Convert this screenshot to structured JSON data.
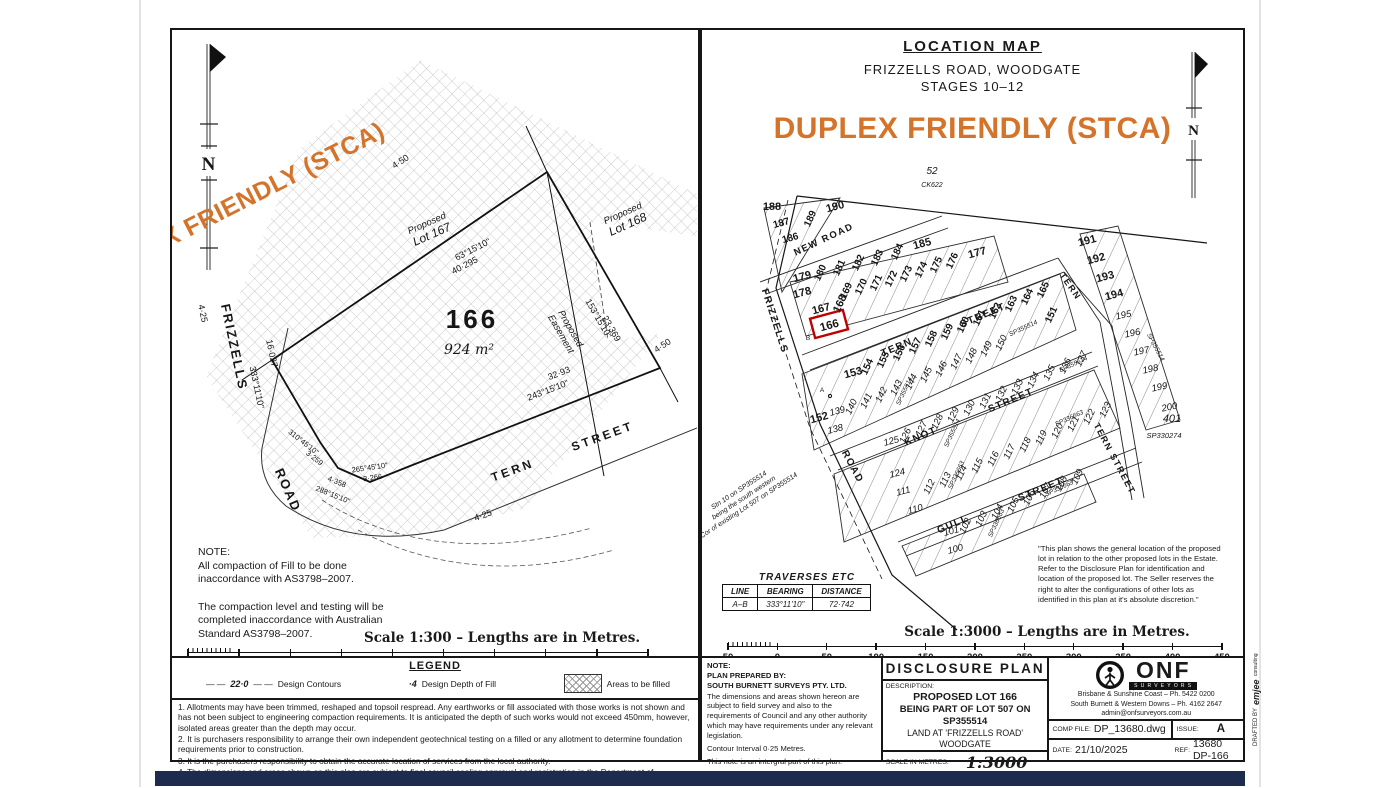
{
  "colors": {
    "accent": "#d4732a",
    "highlight_red": "#c00000",
    "footer_bar": "#1d2b4e",
    "ink": "#1a1a1a"
  },
  "site_plan": {
    "banner": "DUPLEX FRIENDLY (STCA)",
    "north_label": "N",
    "lot_number": "166",
    "lot_area": "924 m²",
    "adjacent": {
      "p167a": "Proposed",
      "p167b": "Lot 167",
      "p168a": "Proposed",
      "p168b": "Lot 168",
      "easea": "Proposed",
      "easeb": "Easement"
    },
    "streets": {
      "frizzells": "FRIZZELLS",
      "road": "ROAD",
      "tern": "TERN",
      "street": "STREET"
    },
    "dims": {
      "d450a": "4·50",
      "d450b": "4·50",
      "d425a": "4·25",
      "d425b": "4·25",
      "b_top": "63°15'10\"",
      "l_top": "40·295",
      "b_east": "153°15'10\"",
      "l_east": "23·369",
      "b_south": "243°15'10\"",
      "l_south": "32·93",
      "b_west": "333°11'10\"",
      "l_west": "16·027",
      "b_c1": "310°45'10\"",
      "l_c1": "3·259",
      "b_c2": "265°45'10\"",
      "l_c2": "3·266",
      "b_c3": "288°15'10\"",
      "l_c3": "4·358"
    },
    "note": "NOTE:\nAll compaction of Fill to be done\ninaccordance with AS3798–2007.\n\nThe compaction level and testing will be\ncompleted inaccordance with Australian\nStandard AS3798–2007.",
    "scale_caption": "Scale 1:300 – Lengths are in Metres.",
    "scale_ticks": [
      "5",
      "0",
      "5",
      "10",
      "15",
      "20",
      "25",
      "30",
      "35",
      "40"
    ]
  },
  "legend": {
    "title": "LEGEND",
    "contour_value": "22·0",
    "contour_label": "Design Contours",
    "depth_symbol": "·4",
    "depth_label": "Design Depth of Fill",
    "fill_label": "Areas to be filled"
  },
  "notes": {
    "n1": "1. Allotments may have been trimmed, reshaped and topsoil respread. Any earthworks or fill associated with those works is not shown and has not been subject to engineering compaction requirements. It is anticipated the depth of such works would not exceed 450mm, however, isolated areas greater than the depth may occur.",
    "n2": "2. It is purchasers responsibility to arrange their own independent geotechnical testing on a filled or any allotment to determine foundation requirements prior to construction.",
    "n3": "3. It is the purchasers responsibility to obtain the accurate location of services from the local authority.",
    "n4": "4. The dimensions and areas shown on this plan are subject to final council sealing approval and registration in the Department of Resources."
  },
  "location_map": {
    "title": "LOCATION MAP",
    "address": "FRIZZELLS ROAD, WOODGATE",
    "stages": "STAGES 10–12",
    "banner": "DUPLEX FRIENDLY (STCA)",
    "north_label": "N",
    "parcel_above": {
      "lot": "52",
      "plan": "CK622"
    },
    "streets": {
      "new_road": "NEW ROAD",
      "tern_1": "TERN",
      "tern_2": "STREET",
      "knot_1": "KNOT",
      "knot_2": "STREET",
      "gull_1": "GULL",
      "gull_2": "STREET",
      "tern_leg": "TERN",
      "tern_vertical": "TERN STREET",
      "frizzells": "FRIZZELLS",
      "road": "ROAD"
    },
    "triangle_lots": [
      "188",
      "187",
      "186",
      "189",
      "190"
    ],
    "row_a": [
      "179",
      "180",
      "181",
      "182",
      "183",
      "184",
      "185"
    ],
    "row_b": [
      "178",
      "169",
      "170",
      "171",
      "172",
      "173",
      "174",
      "175",
      "176",
      "177"
    ],
    "tip_lots": [
      "167",
      "168"
    ],
    "highlight_lot": "166",
    "row_c": [
      "153",
      "154",
      "155",
      "156",
      "157",
      "158",
      "159",
      "160",
      "161",
      "162",
      "163",
      "164",
      "165"
    ],
    "lot_151": "151",
    "row_d": [
      "139",
      "140",
      "141",
      "142",
      "143",
      "144",
      "145",
      "146",
      "147",
      "148",
      "149",
      "150"
    ],
    "lot_152": "152",
    "lot_138": "138",
    "row_e": [
      "125",
      "126",
      "127",
      "128",
      "129",
      "130",
      "131",
      "132",
      "133",
      "134",
      "135",
      "136",
      "137"
    ],
    "row_f": [
      "124",
      "112",
      "113",
      "114",
      "115",
      "116",
      "117",
      "118",
      "119",
      "120",
      "121",
      "122",
      "123"
    ],
    "lot_111": "111",
    "lot_110": "110",
    "row_g": [
      "101",
      "102",
      "103",
      "104",
      "105",
      "106",
      "107",
      "108",
      "109"
    ],
    "lot_100": "100",
    "east_bold": [
      "191",
      "192",
      "193",
      "194"
    ],
    "east_italic": [
      "195",
      "196",
      "197",
      "198",
      "199",
      "200"
    ],
    "remainder": {
      "lot": "401",
      "plan": "SP330274"
    },
    "plan_labels": {
      "sp355514": "SP355514",
      "sp336663": "SP336663"
    },
    "markers": {
      "a": "A",
      "b": "B"
    },
    "annotation": [
      "Stn 10 on SP355514",
      "being the south western",
      "Cor of existing Lot 507 on SP355514"
    ],
    "disclaimer": "\"This plan shows the general location of the proposed lot in relation to the other proposed lots in the Estate. Refer to the Disclosure Plan for identification and location of the proposed lot. The Seller reserves the right to alter the configurations of other lots as identified in this plan at it's absolute discretion.\"",
    "traverses": {
      "title": "TRAVERSES ETC",
      "headers": [
        "LINE",
        "BEARING",
        "DISTANCE"
      ],
      "rows": [
        [
          "A–B",
          "333°11'10\"",
          "72·742"
        ]
      ]
    },
    "scale_caption": "Scale 1:3000 – Lengths are in Metres.",
    "scale_ticks": [
      "50",
      "0",
      "50",
      "100",
      "150",
      "200",
      "250",
      "300",
      "350",
      "400",
      "450"
    ]
  },
  "title_block": {
    "note_title": "NOTE:",
    "prepared_by_label": "PLAN PREPARED BY:",
    "prepared_by": "SOUTH BURNETT SURVEYS PTY. LTD.",
    "note_body": "The dimensions and areas shown hereon are subject to field survey and also to the requirements of Council and any other authority which may have requirements under any relevant legislation.",
    "contour_interval": "Contour Interval 0·25 Metres.",
    "integral_note": "This note is an intergral part of this plan.",
    "plan_type": "DISCLOSURE PLAN",
    "description_label": "DESCRIPTION:",
    "desc1": "PROPOSED LOT 166",
    "desc2": "BEING PART OF LOT 507 ON SP355514",
    "desc3": "LAND AT 'FRIZZELLS ROAD'",
    "desc4": "WOODGATE",
    "scale_label": "SCALE IN METRES:",
    "scale_value": "1:3000",
    "surveyor_name": "ONF",
    "surveyor_sub": "SURVEYORS",
    "contact1": "Brisbane & Sunshine Coast – Ph. 5422 0200",
    "contact2": "South Burnett & Western Downs – Ph. 4162 2647",
    "email": "admin@onfsurveyors.com.au",
    "comp_file_label": "COMP FILE:",
    "comp_file": "DP_13680.dwg",
    "issue_label": "ISSUE:",
    "issue": "A",
    "date_label": "DATE:",
    "date": "21/10/2025",
    "ref_label": "REF:",
    "ref": "13680 DP-166",
    "drafted_label": "DRAFTED BY",
    "drafted_brand": "emjee",
    "drafted_brand2": "consulting"
  }
}
